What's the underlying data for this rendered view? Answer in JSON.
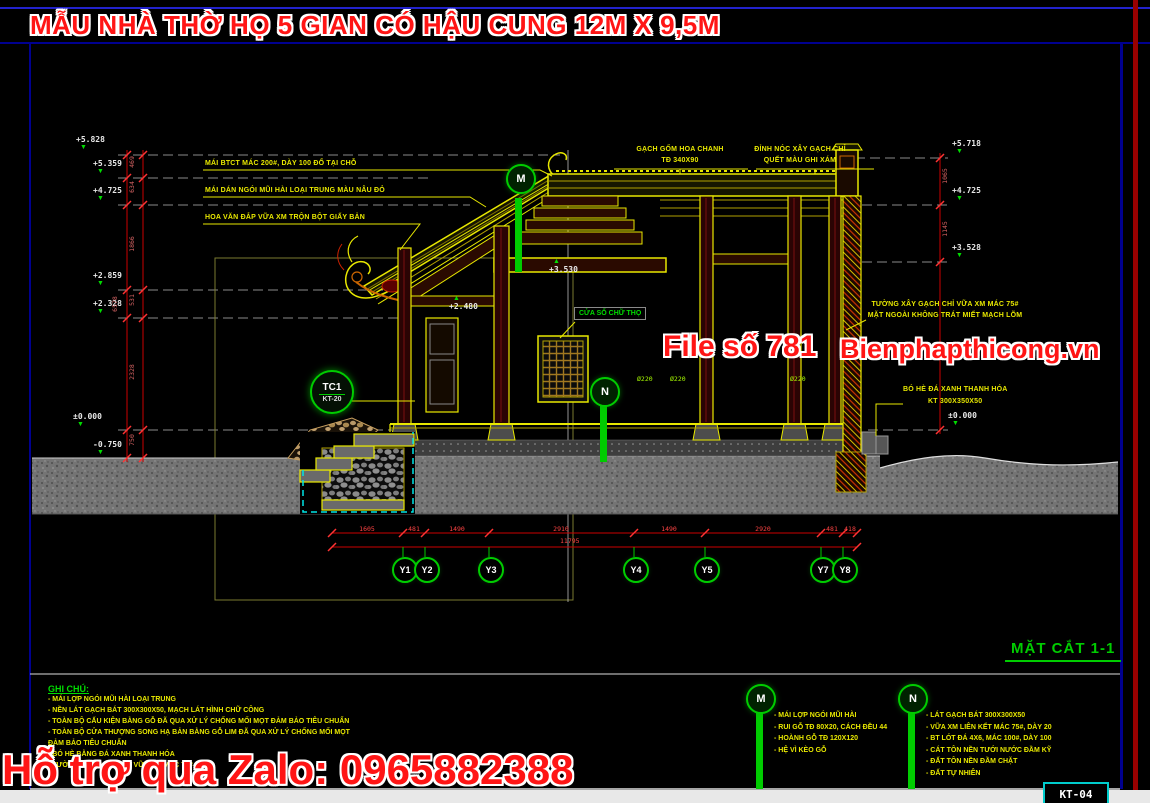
{
  "title": "MẪU NHÀ THỜ HỌ 5 GIAN CÓ HẬU CUNG 12M X 9,5M",
  "section_label": "MẶT CẮT 1-1",
  "sheet_code": "KT-04",
  "watermarks": {
    "file_no": "File số 781",
    "site": "Bienphapthicong.vn",
    "zalo": "Hỗ trợ qua Zalo: 0965882388"
  },
  "left_elevations": [
    "+5.828",
    "+5.359",
    "+4.725",
    "+2.859",
    "+2.328",
    "±0.000",
    "-0.750"
  ],
  "right_elevations": [
    "+5.718",
    "+4.725",
    "+3.528",
    "±0.000"
  ],
  "mid_elevations": [
    "+3.530",
    "+2.480"
  ],
  "left_dims": [
    "469",
    "634",
    "1866",
    "531",
    "2328",
    "750"
  ],
  "left_dims_total": "6578",
  "right_dims": [
    "1065",
    "1145"
  ],
  "left_notes": [
    "MÁI BTCT MÁC 200#, DÀY 100 ĐỔ TẠI CHỖ",
    "MÁI DÁN NGÓI MŨI HÀI LOẠI TRUNG MÀU NÂU ĐỎ",
    "HOA VĂN ĐẮP VỮA XM TRỘN BỘT GIẤY BẢN"
  ],
  "top_notes": [
    {
      "l1": "GẠCH GỐM HOA CHANH",
      "l2": "TĐ 340X90"
    },
    {
      "l1": "ĐỈNH NÓC XÂY GẠCH CHỈ",
      "l2": "QUẾT MÀU GHI XÁM"
    }
  ],
  "right_notes": [
    {
      "l1": "TƯỜNG XÂY GẠCH CHỈ VỮA XM MÁC 75#",
      "l2": "MẶT NGOÀI KHÔNG TRÁT MIẾT MẠCH LÕM"
    },
    {
      "l1": "BÓ HÈ ĐÁ XANH THANH HÓA",
      "l2": "KT 300X350X50"
    }
  ],
  "window_label": "CỬA SỔ CHỮ THỌ",
  "column_labels": [
    "Ø220",
    "Ø220",
    "Ø220"
  ],
  "grid_bubbles": [
    "Y1",
    "Y2",
    "Y3",
    "Y4",
    "Y5",
    "Y7",
    "Y8"
  ],
  "grid_dims": [
    "1605",
    "481",
    "1490",
    "2910",
    "1490",
    "2920",
    "481",
    "418"
  ],
  "grid_total": "11795",
  "callout_m": "M",
  "callout_n": "N",
  "detail_callout": {
    "top": "TC1",
    "bottom": "KT-20"
  },
  "legend_m": {
    "label": "M",
    "items": [
      "- MÁI LỢP NGÓI MŨI HÀI",
      "- RUI GỖ TĐ 80X20, CÁCH ĐỀU 44",
      "- HOÀNH GỖ TĐ 120X120",
      "- HỆ VÌ KÈO GỖ"
    ]
  },
  "legend_n": {
    "label": "N",
    "items": [
      "- LÁT GẠCH BÁT 300X300X50",
      "- VỮA XM LIÊN KẾT MÁC 75#, DÀY 20",
      "- BT LÓT ĐÁ 4X6, MÁC 100#, DÀY 100",
      "- CÁT TÔN NỀN TƯỚI NƯỚC ĐẦM KỸ",
      "- ĐẤT TÔN NỀN ĐẦM CHẶT",
      "- ĐẤT TỰ NHIÊN"
    ]
  },
  "notes": {
    "heading": "GHI CHÚ:",
    "items": [
      "- MÁI LỢP NGÓI MŨI HÀI LOẠI TRUNG",
      "- NỀN LÁT GẠCH BÁT 300X300X50, MẠCH LÁT HÌNH CHỮ CÔNG",
      "- TOÀN BỘ CẤU KIỆN BẰNG GỖ ĐÃ QUA XỬ LÝ CHỐNG MỐI MỌT ĐẢM BẢO TIÊU CHUẨN",
      "- TOÀN BỘ CỬA THƯỢNG SONG HẠ BẢN BẰNG GỖ LIM ĐÃ QUA XỬ LÝ CHỐNG MỐI MỌT",
      "ĐẢM BẢO TIÊU CHUẨN",
      "- BÓ HÈ BẰNG ĐÁ XANH THANH HÓA",
      "- TƯỜNG XÂY GẠCH CHỈ VỮA XM MÁC 75#"
    ]
  },
  "colors": {
    "accent_red": "#ff1515",
    "cad_yellow": "#e8e800",
    "cad_green": "#00cc00",
    "dim_red": "#cc0000",
    "hatch_cyan": "#00cccc",
    "frame_blue": "#000090"
  }
}
